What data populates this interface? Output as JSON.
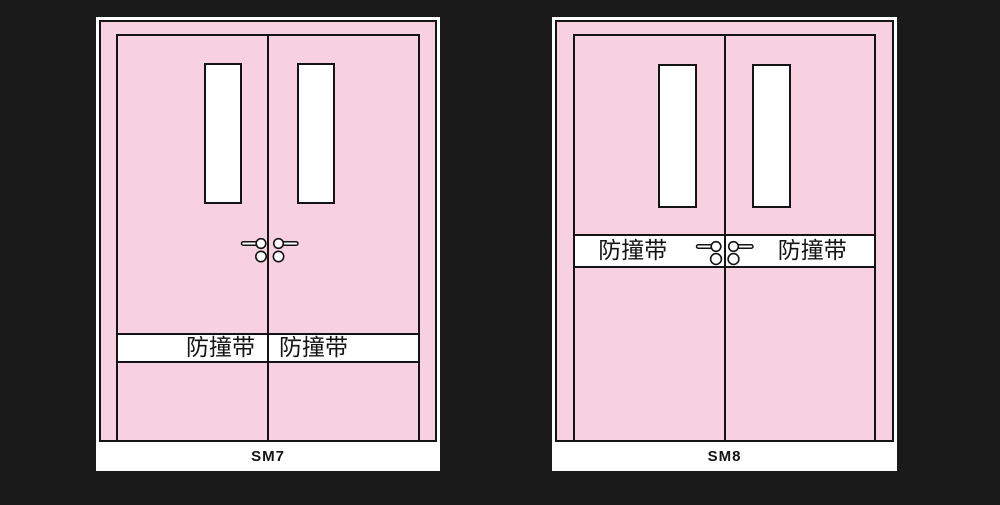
{
  "canvas": {
    "background_color": "#1a1a1a"
  },
  "palette": {
    "door_fill": "#f8d1e1",
    "line": "#141414",
    "panel_background": "#ffffff",
    "text": "#141414"
  },
  "doors": [
    {
      "caption": "SM7",
      "strip": {
        "left_label": "防撞带",
        "right_label": "防撞带",
        "position": "lower-third"
      }
    },
    {
      "caption": "SM8",
      "strip": {
        "left_label": "防撞带",
        "right_label": "防撞带",
        "position": "middle"
      }
    }
  ]
}
